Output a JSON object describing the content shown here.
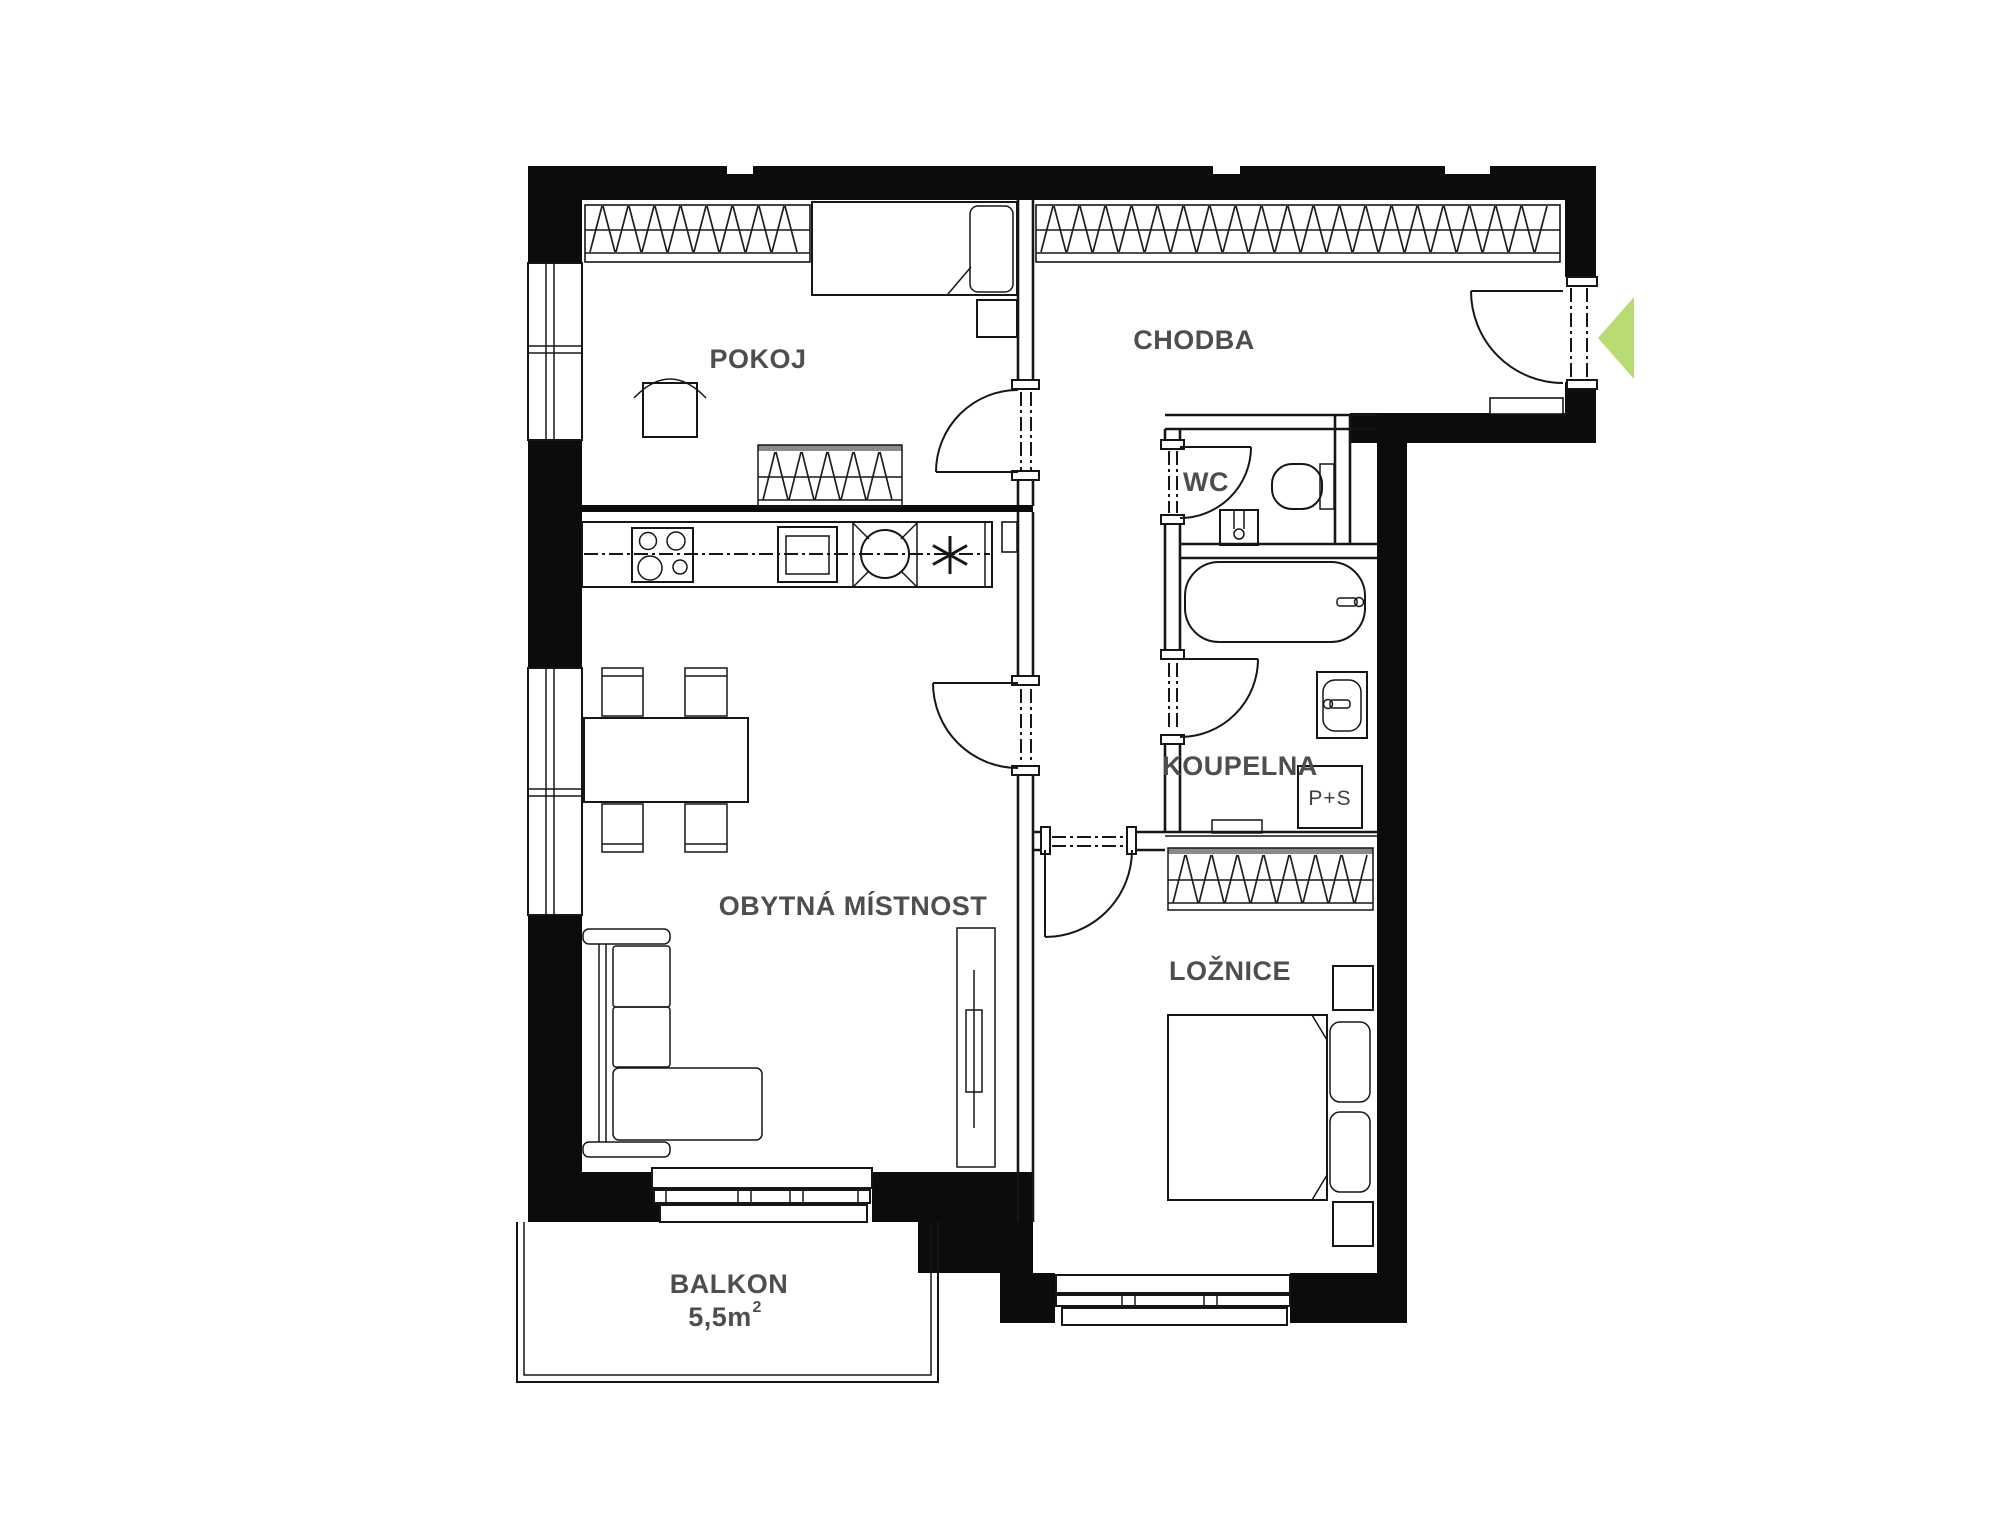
{
  "plan": {
    "rooms": {
      "pokoj": {
        "label": "POKOJ"
      },
      "chodba": {
        "label": "CHODBA"
      },
      "wc": {
        "label": "WC"
      },
      "koupelna": {
        "label": "KOUPELNA"
      },
      "obytna_mistnost": {
        "label": "OBYTNÁ MÍSTNOST"
      },
      "loznice": {
        "label": "LOŽNICE"
      },
      "balkon": {
        "label": "BALKON",
        "area": "5,5m",
        "area_superscript": "2"
      }
    },
    "appliance_labels": {
      "washer_dryer": "P+S"
    },
    "colors": {
      "walls": "#0c0c0c",
      "lines": "#161616",
      "labels": "#4e4e4e",
      "entrance_arrow": "#b9db74"
    }
  }
}
